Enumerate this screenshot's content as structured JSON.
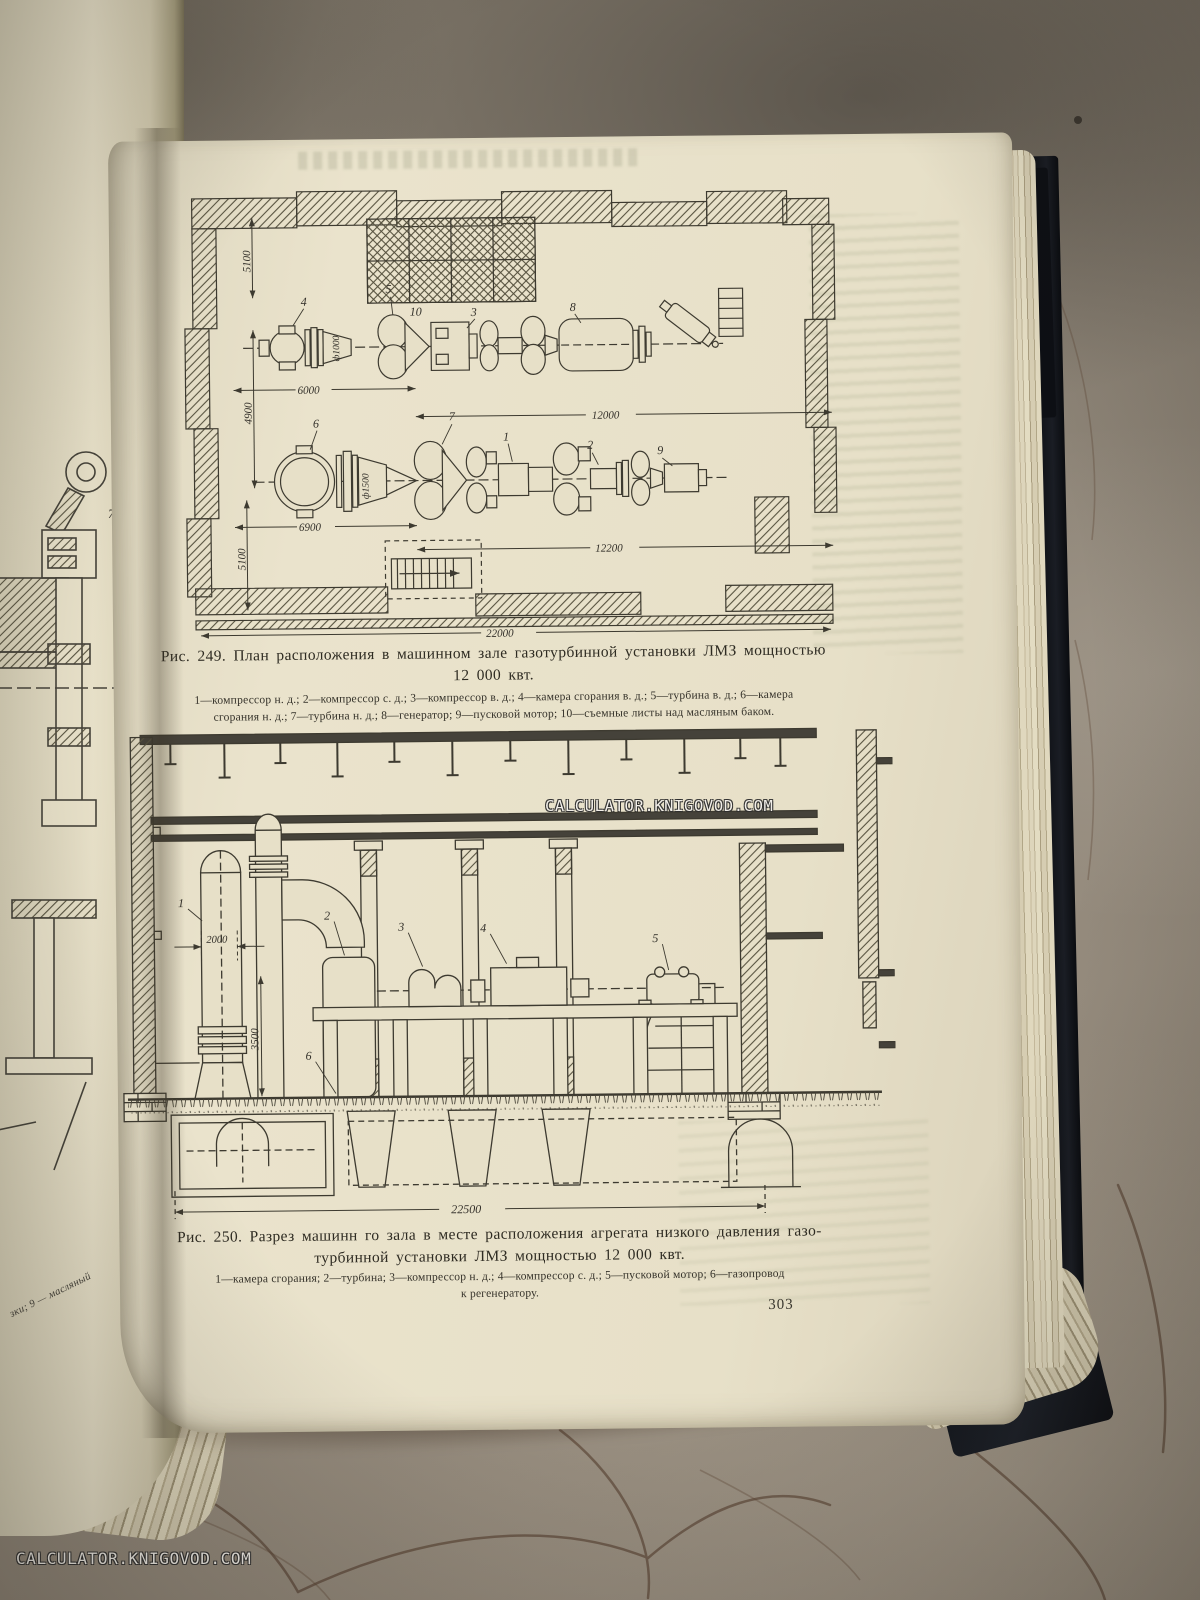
{
  "watermark": {
    "text": "CALCULATOR.KNIGOVOD.COM"
  },
  "page_number": "303",
  "left_page": {
    "figure_label": "7",
    "edge_text_fragment": "зки; 9 — масляный"
  },
  "fig249": {
    "caption_line1": "Рис. 249. План расположения в машинном зале газотурбинной установки ЛМЗ мощностью",
    "caption_line2": "12 000 квт.",
    "legend_line1": "1—компрессор н. д.; 2—компрессор с. д.; 3—компрессор в. д.; 4—камера сгорания в. д.; 5—турбина в. д.; 6—камера",
    "legend_line2": "сгорания н. д.; 7—турбина н. д.; 8—генератор; 9—пусковой мотор; 10—съемные листы над масляным баком.",
    "labels": {
      "l1": "1",
      "l2": "2",
      "l3": "3",
      "l4": "4",
      "l5": "5",
      "l6": "6",
      "l7": "7",
      "l8": "8",
      "l9": "9",
      "l10": "10"
    },
    "dims": {
      "v_top": "5100",
      "v_mid": "4900",
      "v_bot": "5100",
      "h_upper_left": "6000",
      "h_upper_right": "12000",
      "h_lower_left": "6900",
      "h_lower_right": "12200",
      "h_total": "22000",
      "dia_upper": "ф1000",
      "dia_lower": "ф1500"
    }
  },
  "fig250": {
    "caption_line1": "Рис. 250. Разрез машинн го зала в месте расположения агрегата низкого давления газо-",
    "caption_line2": "турбинной установки ЛМЗ мощностью 12 000 квт.",
    "legend_line1": "1—камера сгорания; 2—турбина; 3—компрессор н. д.; 4—компрессор с. д.; 5—пусковой мотор; 6—газопровод",
    "legend_line2": "к регенератору.",
    "labels": {
      "l1": "1",
      "l2": "2",
      "l3": "3",
      "l4": "4",
      "l5": "5",
      "l6": "6"
    },
    "dims": {
      "w_vessel": "2000",
      "h_floor": "3500",
      "w_total": "22500"
    }
  }
}
